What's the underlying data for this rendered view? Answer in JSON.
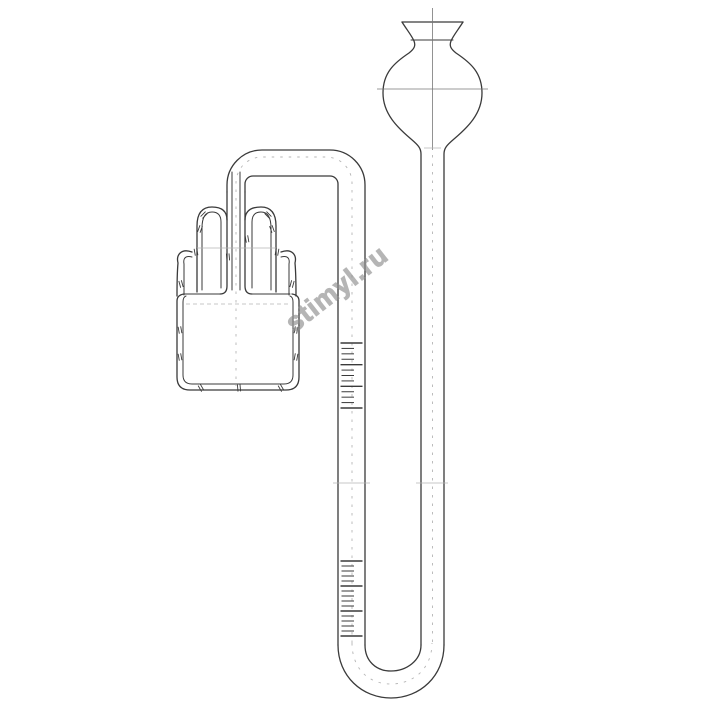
{
  "watermark": {
    "text": "stimyl.ru",
    "color": "#8f8f8f",
    "rotation_deg": -38
  },
  "colors": {
    "background": "#ffffff",
    "line": "#3a3a3a",
    "thin": "#777777",
    "faint": "#b5b5b5",
    "watermark": "#8f8f8f"
  },
  "diagram": {
    "kind": "laboratory-glassware-line-drawing",
    "scales": [
      {
        "name": "upper-scale",
        "x": 340,
        "width_major": 22.5,
        "width_minor": 14,
        "y_start": 343,
        "y_end": 408,
        "ticks": 13,
        "major_every": 4
      },
      {
        "name": "lower-scale",
        "x": 340,
        "width_major": 22.5,
        "width_minor": 14,
        "y_start": 561,
        "y_end": 636,
        "ticks": 16,
        "major_every": 5
      }
    ],
    "hatch_marks": [
      [
        204,
        215,
        -45
      ],
      [
        200,
        229,
        -70
      ],
      [
        268,
        215,
        45
      ],
      [
        272,
        229,
        70
      ],
      [
        247,
        239,
        80
      ],
      [
        228,
        257,
        85
      ],
      [
        181,
        284,
        75
      ],
      [
        292,
        284,
        -75
      ],
      [
        196,
        252,
        80
      ],
      [
        277,
        252,
        -80
      ],
      [
        180,
        330,
        80
      ],
      [
        180,
        357,
        80
      ],
      [
        296,
        330,
        -80
      ],
      [
        296,
        357,
        -80
      ],
      [
        201,
        388,
        60
      ],
      [
        239,
        388,
        85
      ],
      [
        281,
        388,
        60
      ]
    ]
  }
}
